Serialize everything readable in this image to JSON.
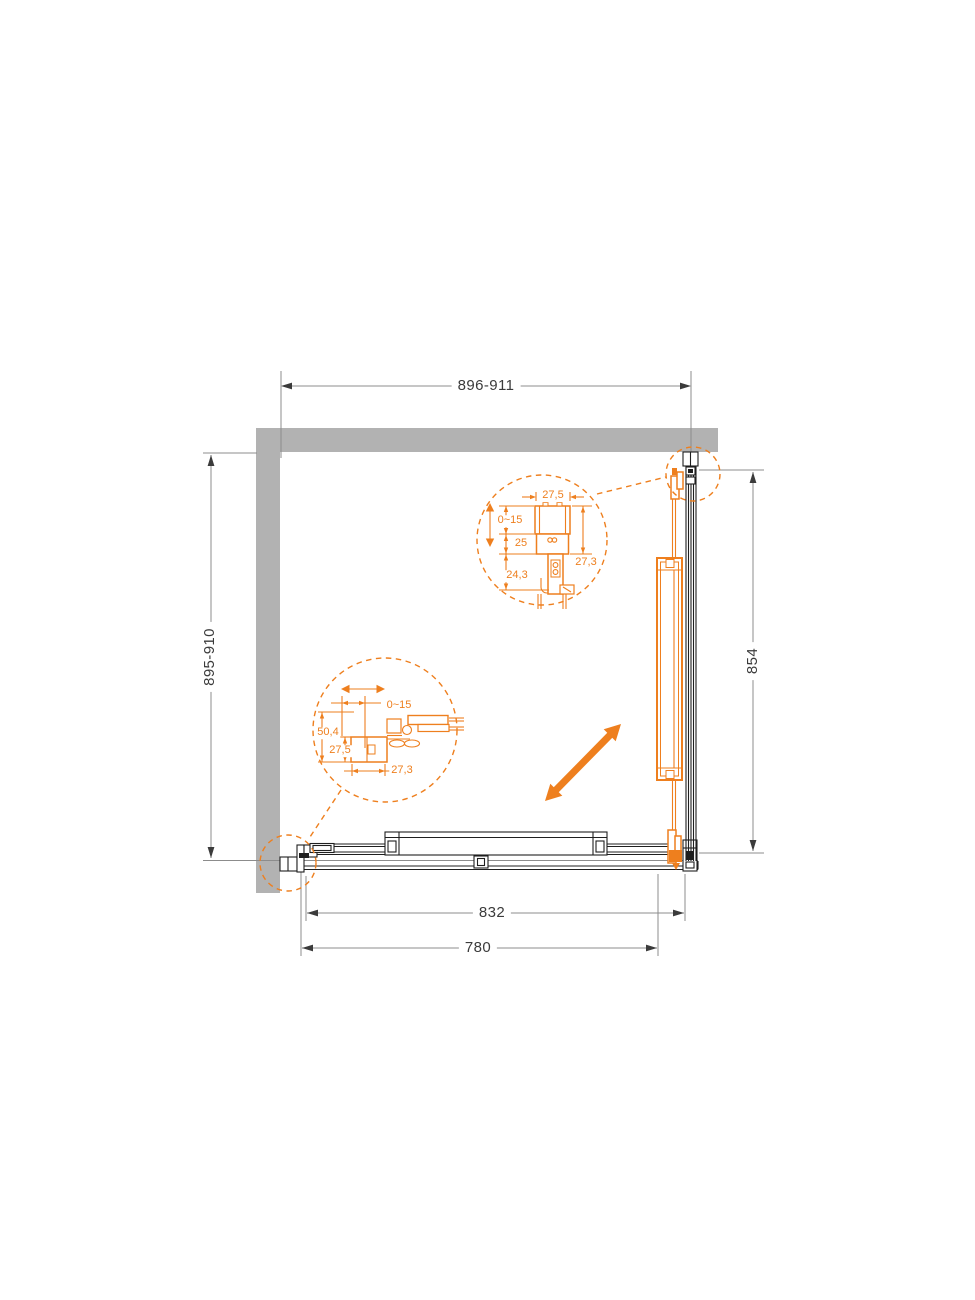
{
  "dims": {
    "top_width_range": "896-911",
    "left_depth_range": "895-910",
    "right_side_height": "854",
    "bottom_outer": "832",
    "bottom_opening": "780"
  },
  "detail_top_rail": {
    "profile_width": "27,5",
    "adjustment_range": "0~15",
    "mid_offset": "25",
    "lower_depth": "24,3",
    "overall_height": "27,3"
  },
  "detail_wall_profile": {
    "adjustment_range": "0~15",
    "overall_depth": "50,4",
    "profile_height": "27,5",
    "profile_width": "27,3"
  },
  "icons": {
    "diagonal_arrow": "double-headed-diagonal-arrow",
    "vertical_adjust_arrow": "double-headed-vertical-arrow",
    "horizontal_adjust_arrow": "double-headed-horizontal-arrow"
  },
  "colors": {
    "accent": "#EE7F1E",
    "wall": "#B2B2B2",
    "hardware": "#1F1F1F",
    "dimension_line": "#8C8C8C",
    "dimension_text": "#3B3B3B"
  }
}
